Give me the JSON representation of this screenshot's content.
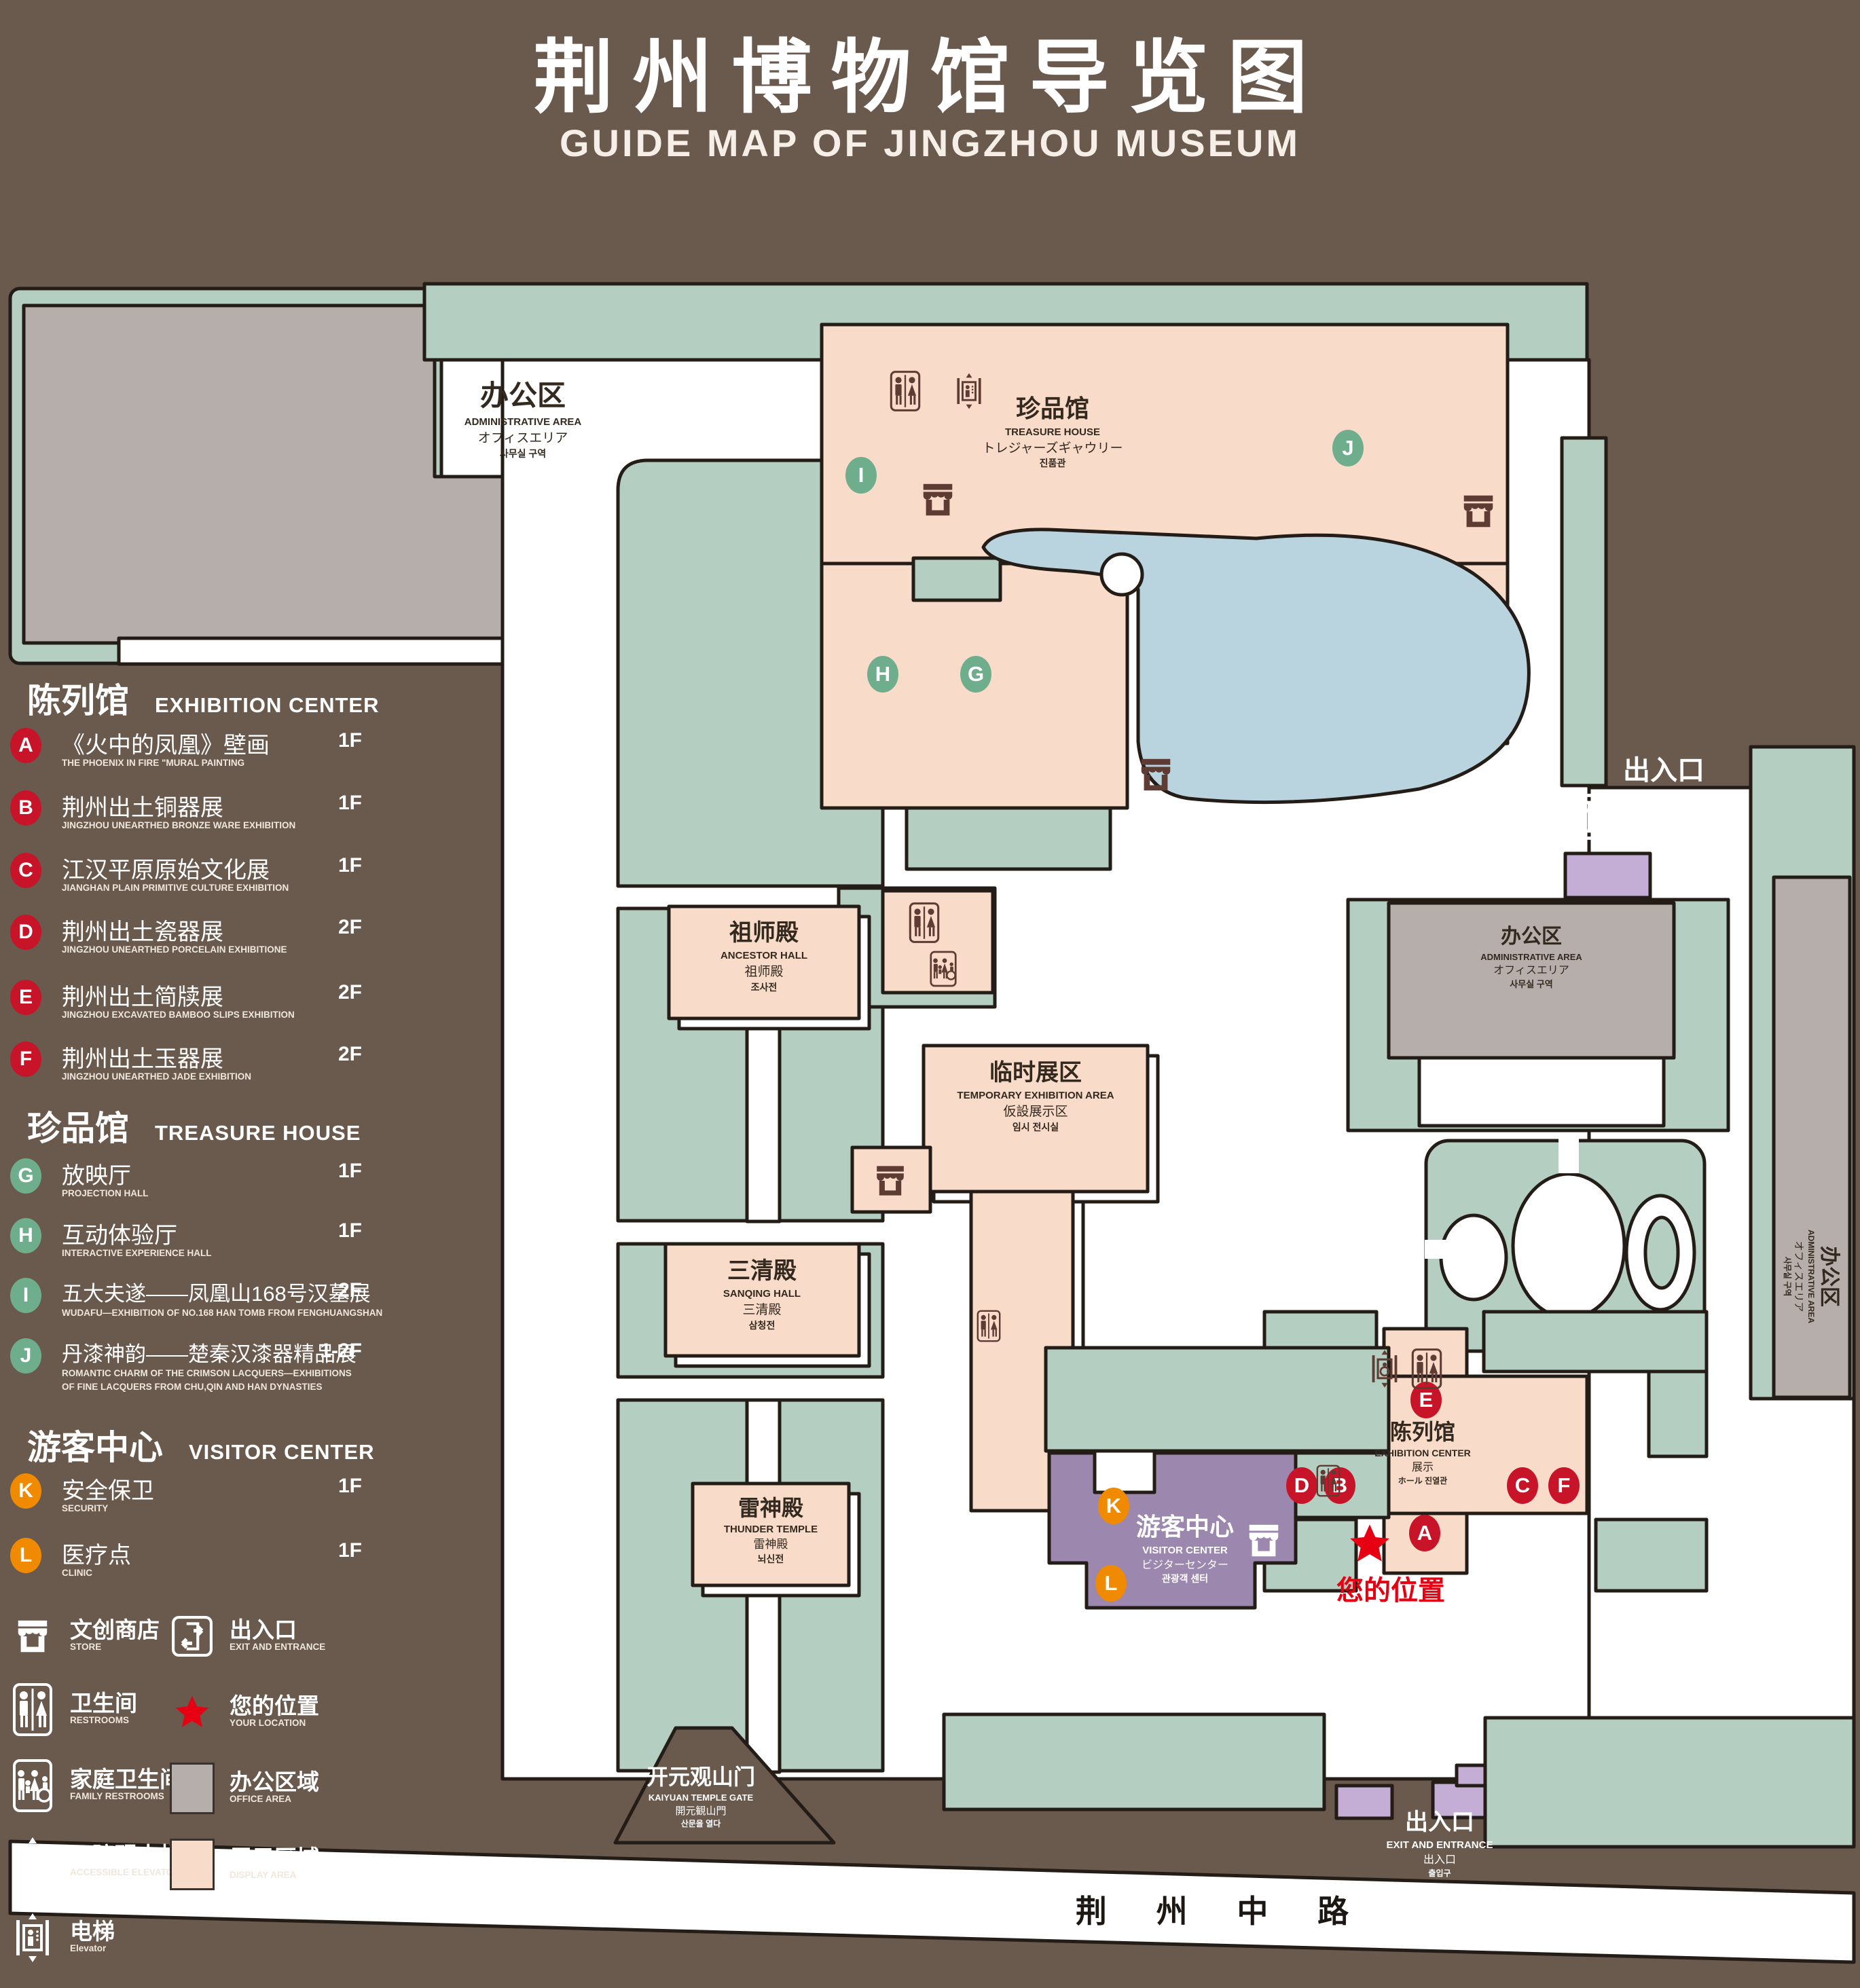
{
  "header": {
    "title": "荆州博物馆导览图",
    "subtitle": "GUIDE MAP OF JINGZHOU MUSEUM"
  },
  "colors": {
    "background_brown": "#6a594d",
    "area_green": "#b5cec2",
    "display_peach": "#f9dbc9",
    "office_gray": "#b6aeab",
    "pond_blue": "#b9d4df",
    "visitor_purple": "#9c88ae",
    "entrance_purple": "#c5aed6",
    "badge_red": "#c81428",
    "badge_green": "#6fae8c",
    "badge_orange": "#f08a00",
    "star_red": "#e60012"
  },
  "sections": {
    "exhibition": {
      "zh": "陈列馆",
      "en": "EXHIBITION CENTER",
      "items": [
        {
          "letter": "A",
          "zh": "《火中的凤凰》壁画",
          "en": "THE PHOENIX IN FIRE \"MURAL PAINTING",
          "floor": "1F"
        },
        {
          "letter": "B",
          "zh": "荆州出土铜器展",
          "en": "JINGZHOU UNEARTHED BRONZE WARE EXHIBITION",
          "floor": "1F"
        },
        {
          "letter": "C",
          "zh": "江汉平原原始文化展",
          "en": "JIANGHAN PLAIN PRIMITIVE CULTURE EXHIBITION",
          "floor": "1F"
        },
        {
          "letter": "D",
          "zh": "荆州出土瓷器展",
          "en": "JINGZHOU UNEARTHED PORCELAIN EXHIBITIONE",
          "floor": "2F"
        },
        {
          "letter": "E",
          "zh": "荆州出土简牍展",
          "en": "JINGZHOU EXCAVATED BAMBOO SLIPS EXHIBITION",
          "floor": "2F"
        },
        {
          "letter": "F",
          "zh": "荆州出土玉器展",
          "en": "JINGZHOU UNEARTHED JADE EXHIBITION",
          "floor": "2F"
        }
      ]
    },
    "treasure": {
      "zh": "珍品馆",
      "en": "TREASURE HOUSE",
      "items": [
        {
          "letter": "G",
          "zh": "放映厅",
          "en": "PROJECTION HALL",
          "floor": "1F"
        },
        {
          "letter": "H",
          "zh": "互动体验厅",
          "en": "INTERACTIVE EXPERIENCE HALL",
          "floor": "1F"
        },
        {
          "letter": "I",
          "zh": "五大夫遂——凤凰山168号汉墓展",
          "en": "WUDAFU—EXHIBITION OF NO.168 HAN TOMB FROM FENGHUANGSHAN",
          "floor": "2F"
        },
        {
          "letter": "J",
          "zh": "丹漆神韵——楚秦汉漆器精品展",
          "en": "ROMANTIC CHARM OF THE CRIMSON LACQUERS—EXHIBITIONS\nOF FINE LACQUERS FROM CHU,QIN AND HAN DYNASTIES",
          "floor": "1-2F"
        }
      ]
    },
    "visitor": {
      "zh": "游客中心",
      "en": "VISITOR CENTER",
      "items": [
        {
          "letter": "K",
          "zh": "安全保卫",
          "en": "SECURITY",
          "floor": "1F"
        },
        {
          "letter": "L",
          "zh": "医疗点",
          "en": "CLINIC",
          "floor": "1F"
        }
      ]
    }
  },
  "legend": {
    "store": {
      "zh": "文创商店",
      "en": "STORE"
    },
    "restrooms": {
      "zh": "卫生间",
      "en": "RESTROOMS"
    },
    "family": {
      "zh": "家庭卫生间",
      "en": "FAMILY RESTROOMS"
    },
    "accessible": {
      "zh": "无障碍电梯",
      "en": "ACCESSIBLE ELEVATOR"
    },
    "elevator": {
      "zh": "电梯",
      "en": "Elevator"
    },
    "exit": {
      "zh": "出入口",
      "en": "EXIT AND ENTRANCE"
    },
    "location": {
      "zh": "您的位置",
      "en": "YOUR LOCATION"
    },
    "office": {
      "zh": "办公区域",
      "en": "OFFICE AREA"
    },
    "display": {
      "zh": "展示区域",
      "en": "DISPLAY AREA"
    }
  },
  "map": {
    "admin_nw": {
      "zh": "办公区",
      "en": "ADMINISTRATIVE AREA",
      "ja": "オフィスエリア",
      "ko": "사무실 구역"
    },
    "admin_mid": {
      "zh": "办公区",
      "en": "ADMINISTRATIVE AREA",
      "ja": "オフィスエリア",
      "ko": "사무실 구역"
    },
    "admin_east": {
      "zh": "办公区",
      "en": "ADMINISTRATIVE AREA",
      "ja": "オフィスエリア",
      "ko": "사무실 구역"
    },
    "treasure": {
      "zh": "珍品馆",
      "en": "TREASURE HOUSE",
      "ja": "トレジャーズギャウリー",
      "ko": "진품관"
    },
    "ancestor": {
      "zh": "祖师殿",
      "en": "ANCESTOR HALL",
      "ja": "祖师殿",
      "ko": "조사전"
    },
    "sanqing": {
      "zh": "三清殿",
      "en": "SANQING HALL",
      "ja": "三清殿",
      "ko": "삼청전"
    },
    "thunder": {
      "zh": "雷神殿",
      "en": "THUNDER TEMPLE",
      "ja": "雷神殿",
      "ko": "뇌신전"
    },
    "temporary": {
      "zh": "临时展区",
      "en": "TEMPORARY EXHIBITION AREA",
      "ja": "仮設展示区",
      "ko": "임시 전시실"
    },
    "visitor": {
      "zh": "游客中心",
      "en": "VISITOR CENTER",
      "ja": "ビジターセンター",
      "ko": "관광객 센터"
    },
    "exhibition": {
      "zh": "陈列馆",
      "en": "EXHIBITION CENTER",
      "ja": "展示",
      "ko": "ホール 진열관"
    },
    "exit_right": {
      "zh": "出入口",
      "en": "EXIT AND ENTRANCE",
      "ja": "出入口",
      "ko": "출입구"
    },
    "exit_bottom": {
      "zh": "出入口",
      "en": "EXIT AND ENTRANCE",
      "ja": "出入口",
      "ko": "출입구"
    },
    "gate": {
      "zh": "开元观山门",
      "en": "KAIYUAN TEMPLE GATE",
      "ja": "開元観山門",
      "ko": "산문을 열다"
    },
    "road": "荆 州 中 路",
    "your_location": "您的位置",
    "markers": {
      "A": "A",
      "B": "B",
      "C": "C",
      "D": "D",
      "E": "E",
      "F": "F",
      "G": "G",
      "H": "H",
      "I": "I",
      "J": "J",
      "K": "K",
      "L": "L"
    }
  }
}
